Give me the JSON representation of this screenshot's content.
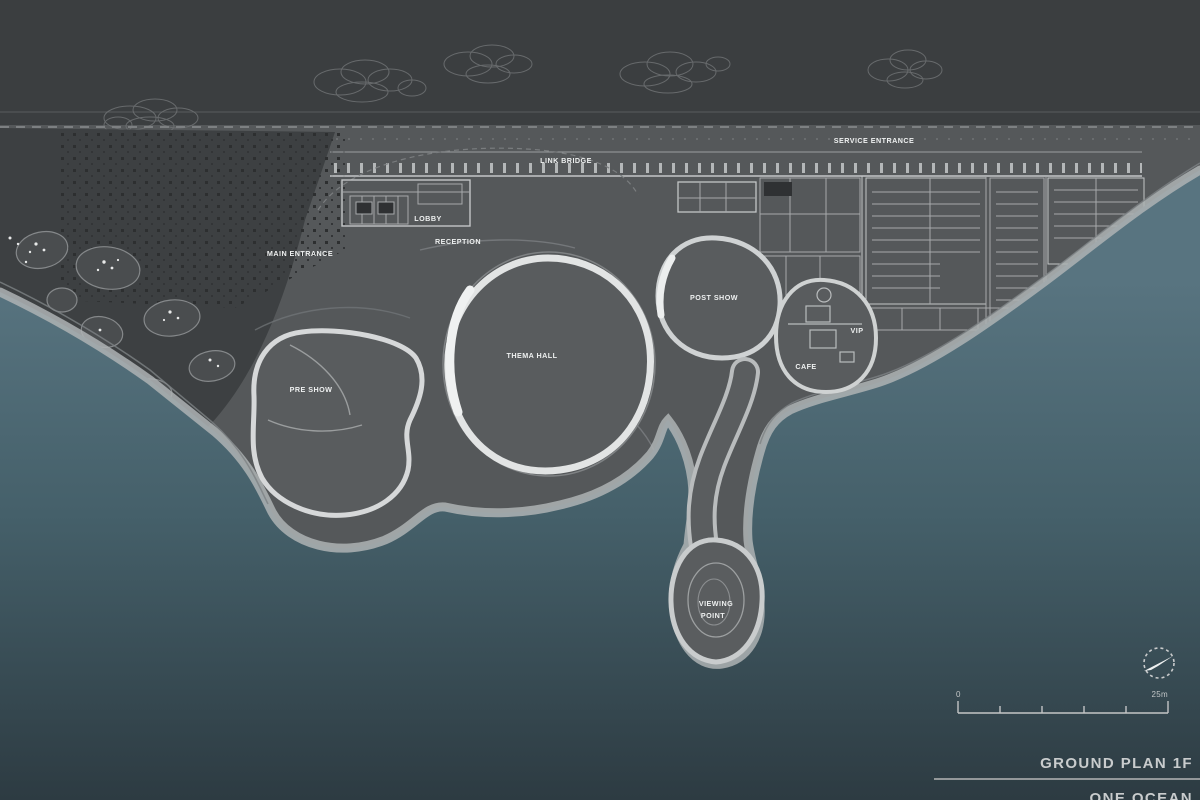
{
  "titles": {
    "plan_title": "GROUND PLAN 1F",
    "project_title": "ONE OCEAN"
  },
  "scale_bar": {
    "zero_label": "0",
    "max_label": "25m"
  },
  "labels": [
    {
      "id": "main-entrance",
      "text": "MAIN ENTRANCE"
    },
    {
      "id": "lobby",
      "text": "LOBBY"
    },
    {
      "id": "reception",
      "text": "RECEPTION"
    },
    {
      "id": "link-bridge",
      "text": "LINK BRIDGE"
    },
    {
      "id": "service-entrance",
      "text": "SERVICE ENTRANCE"
    },
    {
      "id": "pre-show",
      "text": "PRE SHOW"
    },
    {
      "id": "thema-hall",
      "text": "THEMA HALL"
    },
    {
      "id": "post-show",
      "text": "POST SHOW"
    },
    {
      "id": "vip",
      "text": "VIP"
    },
    {
      "id": "cafe",
      "text": "CAFE"
    },
    {
      "id": "viewing-point-line1",
      "text": "VIEWING"
    },
    {
      "id": "viewing-point-line2",
      "text": "POINT"
    }
  ],
  "colors": {
    "background": "#3b3e40",
    "plaza": "#55585a",
    "landscape": "#3d4042",
    "sea_top": "#587480",
    "sea_mid": "#45606a",
    "sea_bottom": "#2d3b42",
    "coast_band": "#aeb3b4",
    "building_line": "#a6a9ab",
    "shell_rim": "#e2e4e4",
    "label_text": "#eef0f0",
    "title_text": "#c9cccd"
  }
}
